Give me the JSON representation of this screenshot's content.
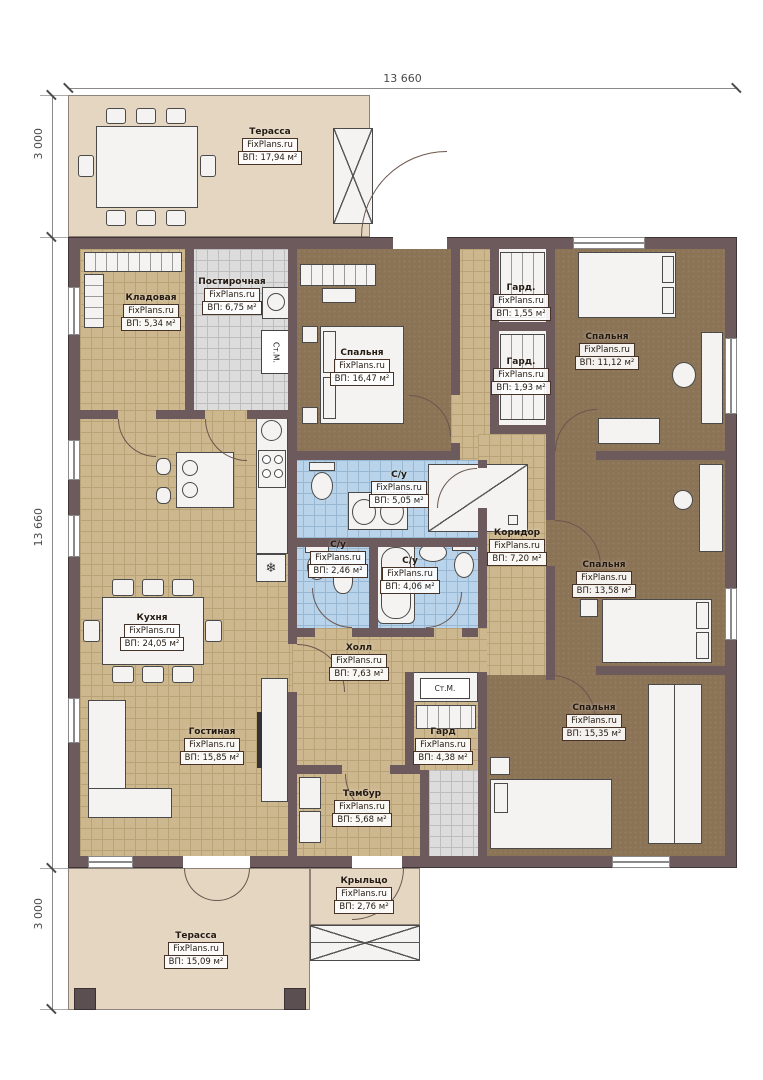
{
  "plan": {
    "dimensions": {
      "top": "13 660",
      "left_top": "3 000",
      "left_middle": "13 660",
      "left_bottom": "3 000"
    },
    "rooms": [
      {
        "name": "Терасса",
        "brand": "FixPlans.ru",
        "area": "ВП: 17,94 м²"
      },
      {
        "name": "Кладовая",
        "brand": "FixPlans.ru",
        "area": "ВП: 5,34 м²"
      },
      {
        "name": "Постирочная",
        "brand": "FixPlans.ru",
        "area": "ВП: 6,75 м²"
      },
      {
        "name": "Спальня",
        "brand": "FixPlans.ru",
        "area": "ВП: 16,47 м²"
      },
      {
        "name": "Гард.",
        "brand": "FixPlans.ru",
        "area": "ВП: 1,55 м²"
      },
      {
        "name": "Гард.",
        "brand": "FixPlans.ru",
        "area": "ВП: 1,93 м²"
      },
      {
        "name": "Спальня",
        "brand": "FixPlans.ru",
        "area": "ВП: 11,12 м²"
      },
      {
        "name": "С/у",
        "brand": "FixPlans.ru",
        "area": "ВП: 5,05 м²"
      },
      {
        "name": "С/у",
        "brand": "FixPlans.ru",
        "area": "ВП: 2,46 м²"
      },
      {
        "name": "С/у",
        "brand": "FixPlans.ru",
        "area": "ВП: 4,06 м²"
      },
      {
        "name": "Коридор",
        "brand": "FixPlans.ru",
        "area": "ВП: 7,20 м²"
      },
      {
        "name": "Спальня",
        "brand": "FixPlans.ru",
        "area": "ВП: 13,58 м²"
      },
      {
        "name": "Кухня",
        "brand": "FixPlans.ru",
        "area": "ВП: 24,05 м²"
      },
      {
        "name": "Холл",
        "brand": "FixPlans.ru",
        "area": "ВП: 7,63 м²"
      },
      {
        "name": "Гостиная",
        "brand": "FixPlans.ru",
        "area": "ВП: 15,85 м²"
      },
      {
        "name": "Гард",
        "brand": "FixPlans.ru",
        "area": "ВП: 4,38 м²"
      },
      {
        "name": "Спальня",
        "brand": "FixPlans.ru",
        "area": "ВП: 15,35 м²"
      },
      {
        "name": "Тамбур",
        "brand": "FixPlans.ru",
        "area": "ВП: 5,68 м²"
      },
      {
        "name": "Крыльцо",
        "brand": "FixPlans.ru",
        "area": "ВП: 2,76 м²"
      },
      {
        "name": "Терасса",
        "brand": "FixPlans.ru",
        "area": "ВП: 15,09 м²"
      }
    ],
    "appliances": {
      "washer_1": "Ст.М.",
      "washer_2": "Ст.М."
    },
    "symbols": {
      "fridge": "❄"
    },
    "colors": {
      "wall": "#6d5a5c",
      "terrace_floor": "#e4d6c1",
      "tile_floor": "#cdb78e",
      "bath_floor": "#b9d4ea",
      "laundry_floor": "#dcdcdc",
      "carpet": "#8b7356"
    }
  }
}
